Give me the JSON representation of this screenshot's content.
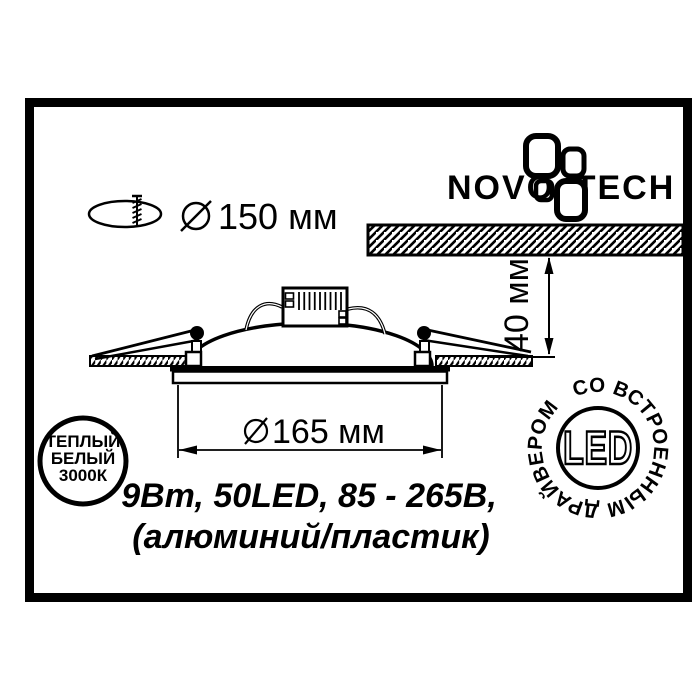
{
  "diagram": {
    "logo": {
      "left": "NOVO",
      "right": "TECH"
    },
    "cutout": {
      "label": "150 мм"
    },
    "depth": {
      "label": "40 мм"
    },
    "diameter": {
      "label": "165 мм"
    },
    "badge_color": {
      "line1": "ТЕПЛЫЙ",
      "line2": "БЕЛЫЙ",
      "line3": "3000К"
    },
    "badge_led": {
      "center": "LED",
      "ring": "СО ВСТРОЕННЫМ ДРАЙВЕРОМ"
    },
    "specs": {
      "line1": "9Вт, 50LED, 85 - 265В,",
      "line2": "(алюминий/пластик)"
    },
    "colors": {
      "ink": "#000000",
      "paper": "#ffffff"
    }
  }
}
